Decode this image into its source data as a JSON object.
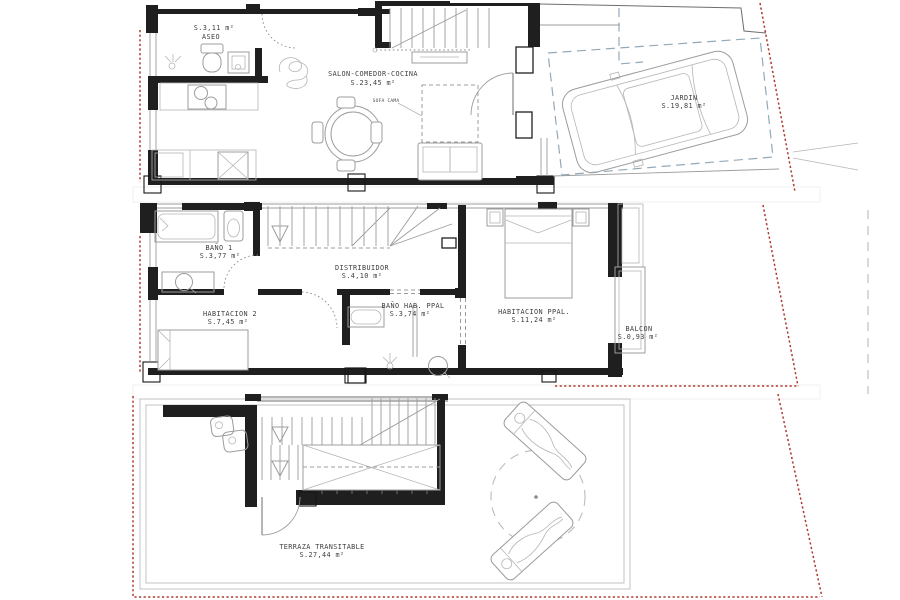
{
  "colors": {
    "wall": "#1f1f1f",
    "furniture": "#9c9c9c",
    "boundary_red": "#b0392c",
    "boundary_blue": "#92a9ba",
    "hatch": "#cfcfcf",
    "text": "#3e3e3e"
  },
  "floors": [
    {
      "id": "planta-baja",
      "rooms": [
        {
          "key": "aseo",
          "name": "ASEO",
          "area": "S.3,11 m²"
        },
        {
          "key": "salon",
          "name": "SALON-COMEDOR-COCINA",
          "area": "S.23,45 m²"
        },
        {
          "key": "jardin",
          "name": "JARDIN",
          "area": "S.19,81 m²"
        }
      ]
    },
    {
      "id": "planta-primera",
      "rooms": [
        {
          "key": "bano1",
          "name": "BAÑO 1",
          "area": "S.3,77 m²"
        },
        {
          "key": "distribuidor",
          "name": "DISTRIBUIDOR",
          "area": "S.4,10 m²"
        },
        {
          "key": "habitacion2",
          "name": "HABITACION 2",
          "area": "S.7,45 m²"
        },
        {
          "key": "banoppal",
          "name": "BAÑO HAB. PPAL",
          "area": "S.3,74 m²"
        },
        {
          "key": "habppal",
          "name": "HABITACION PPAL.",
          "area": "S.11,24 m²"
        },
        {
          "key": "balcon",
          "name": "BALCON",
          "area": "S.0,93 m²"
        }
      ]
    },
    {
      "id": "cubierta",
      "rooms": [
        {
          "key": "terraza",
          "name": "TERRAZA TRANSITABLE",
          "area": "S.27,44 m²"
        }
      ]
    }
  ],
  "annotations": {
    "sofa_cama": "SOFA CAMA"
  }
}
